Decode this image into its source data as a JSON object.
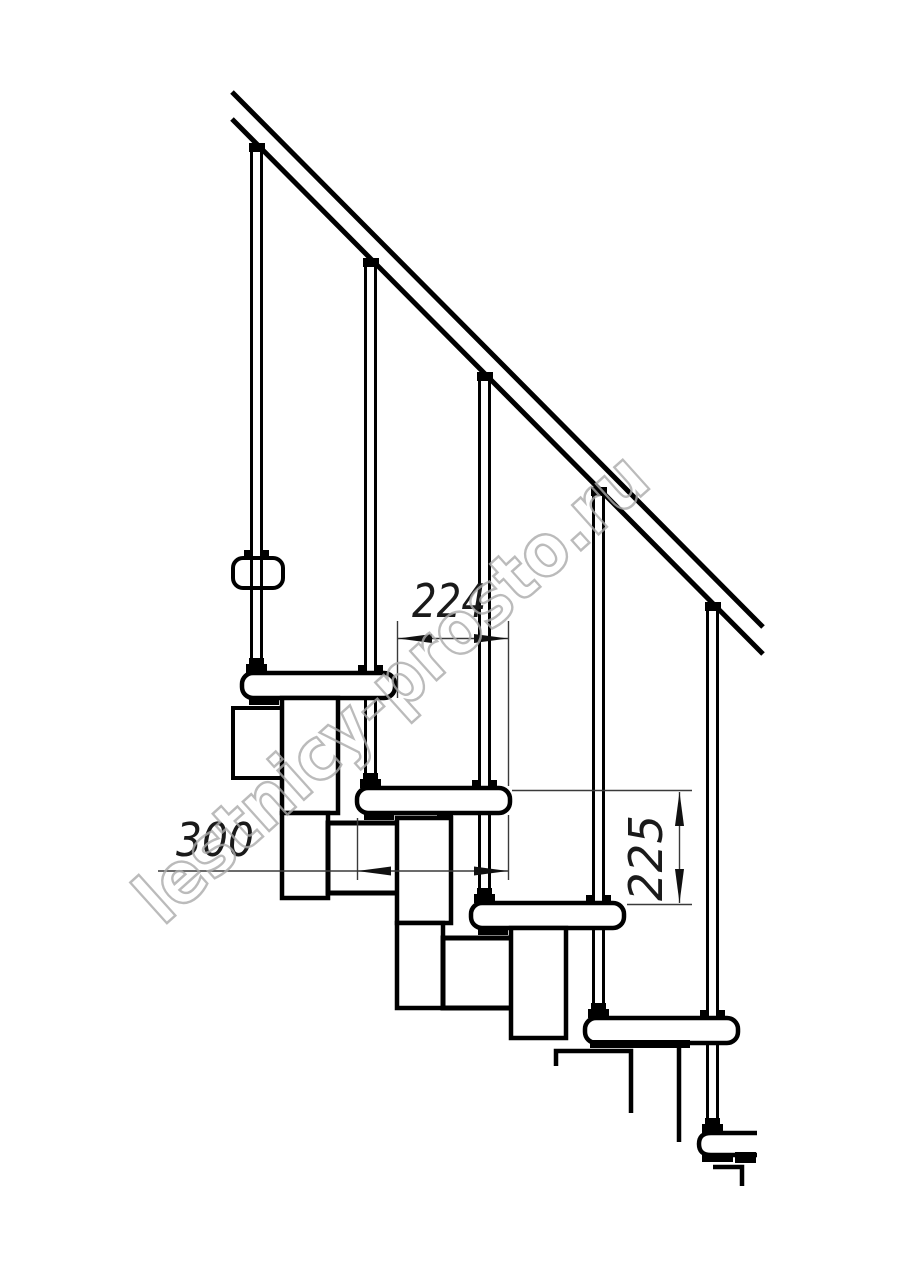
{
  "drawing": {
    "title": "modular-staircase-side-elevation",
    "dimensions": {
      "tread_offset": "224",
      "tread_width": "300",
      "step_rise": "225"
    },
    "watermark": "lestnicy-prosto.ru",
    "colors": {
      "line": "#000000",
      "dimension": "#3a3a3a",
      "watermark": "#ababab",
      "background": "#ffffff"
    }
  }
}
